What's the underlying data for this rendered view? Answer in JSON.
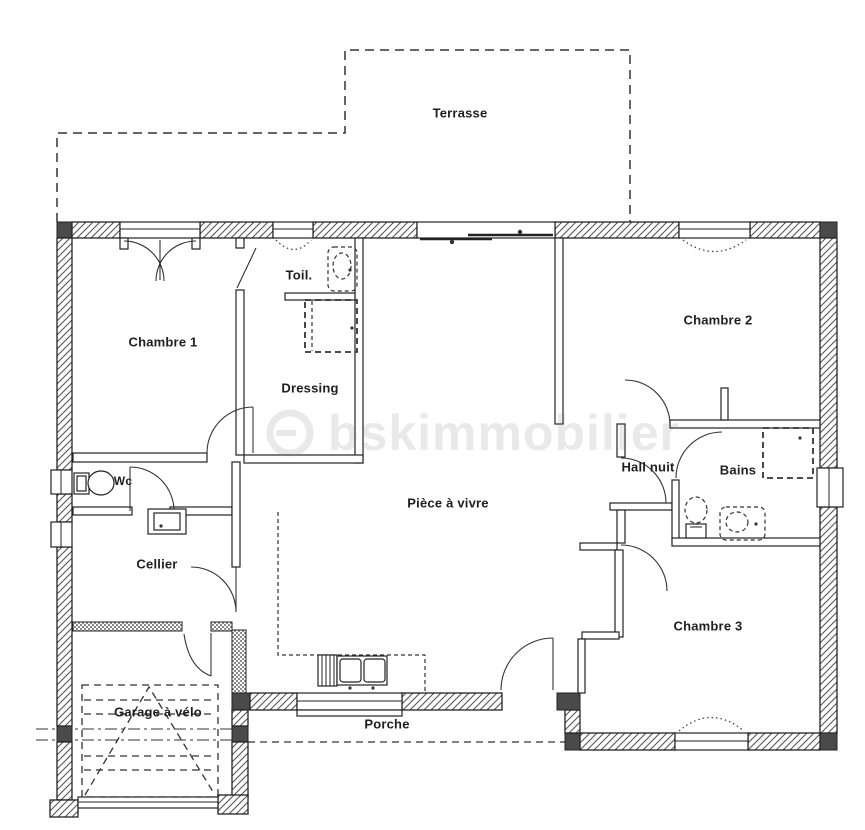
{
  "plan": {
    "watermark": "bskimmobilier",
    "rooms": {
      "terrasse": {
        "label": "Terrasse"
      },
      "chambre1": {
        "label": "Chambre 1"
      },
      "toilettes": {
        "label": "Toil."
      },
      "dressing": {
        "label": "Dressing"
      },
      "chambre2": {
        "label": "Chambre 2"
      },
      "hall_nuit": {
        "label": "Hall nuit"
      },
      "bains": {
        "label": "Bains"
      },
      "wc": {
        "label": "Wc"
      },
      "piece_a_vivre": {
        "label": "Pièce à vivre"
      },
      "cellier": {
        "label": "Cellier"
      },
      "chambre3": {
        "label": "Chambre 3"
      },
      "garage": {
        "label": "Garage à vélo"
      },
      "porche": {
        "label": "Porche"
      }
    },
    "colors": {
      "wall_stroke": "#222222",
      "wall_fill_dark": "#4a4a4a",
      "hatch_line": "#555555",
      "label_text": "#1f1f1f",
      "watermark": "#e9e9e9",
      "background": "#ffffff"
    }
  }
}
